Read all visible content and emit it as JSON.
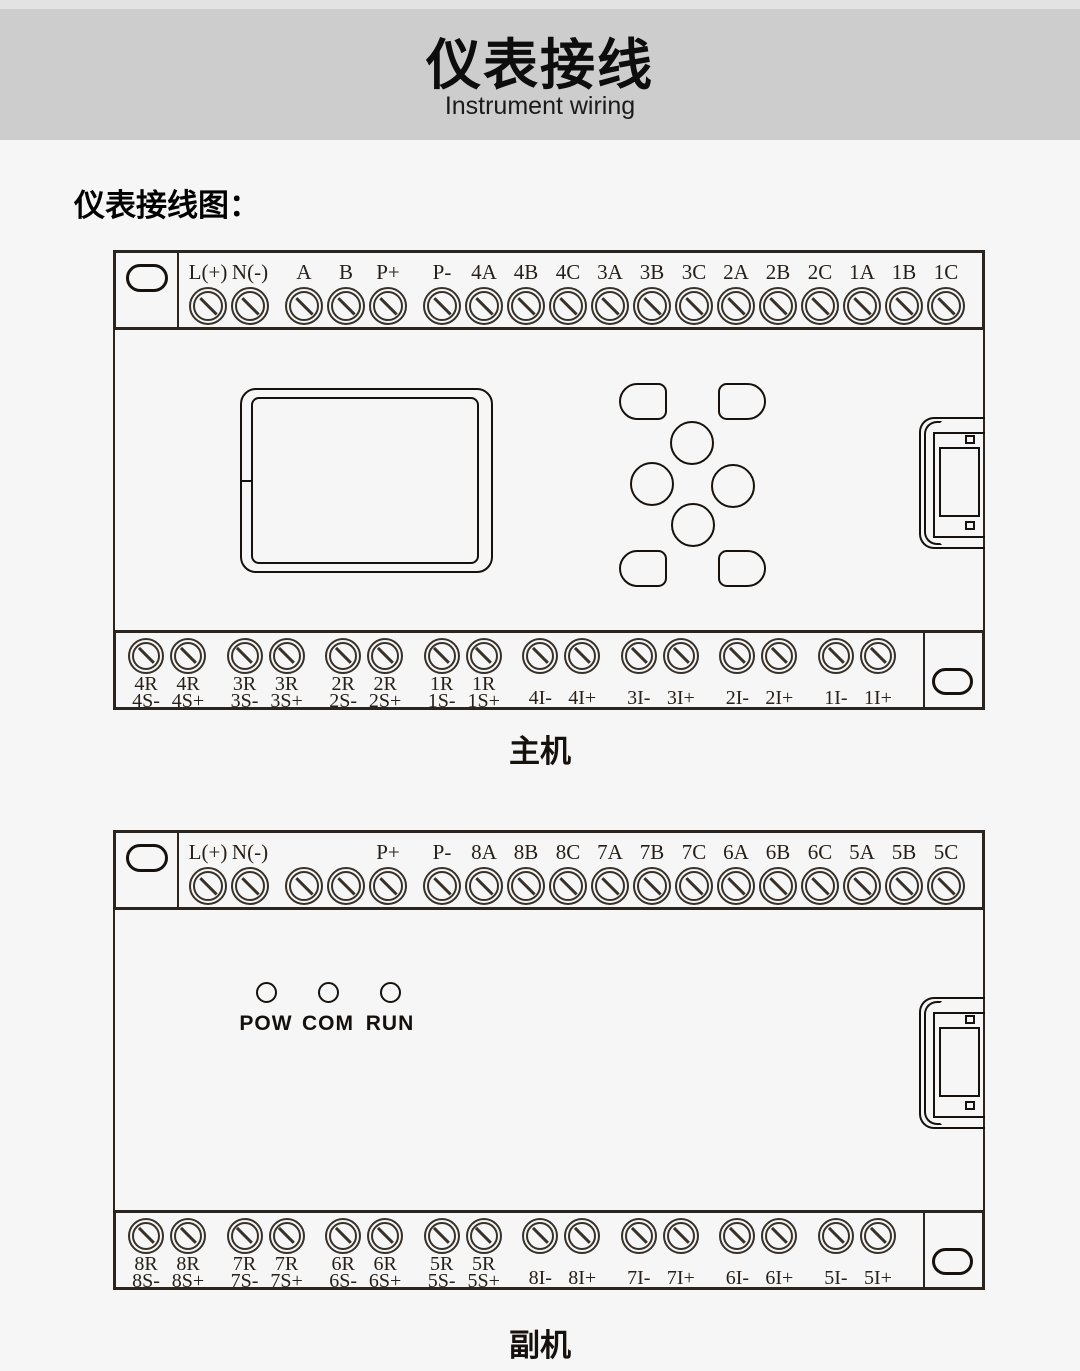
{
  "colors": {
    "page_bg": "#f6f6f6",
    "top_strip": "#e3e3e3",
    "header_band": "#cdcdcd",
    "line": "#2b241f"
  },
  "header": {
    "title": "仪表接线",
    "subtitle": "Instrument wiring"
  },
  "section_heading": "仪表接线图：",
  "main_unit": {
    "caption": "主机",
    "top_groups": [
      [
        "L(+)",
        "N(-)"
      ],
      [
        "A",
        "B",
        "P+"
      ],
      [
        "P-",
        "4A",
        "4B",
        "4C",
        "3A",
        "3B",
        "3C",
        "2A",
        "2B",
        "2C",
        "1A",
        "1B",
        "1C"
      ]
    ],
    "bottom_pairs": [
      [
        {
          "l1": "4R",
          "l2": "4S-"
        },
        {
          "l1": "4R",
          "l2": "4S+"
        }
      ],
      [
        {
          "l1": "3R",
          "l2": "3S-"
        },
        {
          "l1": "3R",
          "l2": "3S+"
        }
      ],
      [
        {
          "l1": "2R",
          "l2": "2S-"
        },
        {
          "l1": "2R",
          "l2": "2S+"
        }
      ],
      [
        {
          "l1": "1R",
          "l2": "1S-"
        },
        {
          "l1": "1R",
          "l2": "1S+"
        }
      ],
      [
        {
          "l1": "",
          "l2": "4I-"
        },
        {
          "l1": "",
          "l2": "4I+"
        }
      ],
      [
        {
          "l1": "",
          "l2": "3I-"
        },
        {
          "l1": "",
          "l2": "3I+"
        }
      ],
      [
        {
          "l1": "",
          "l2": "2I-"
        },
        {
          "l1": "",
          "l2": "2I+"
        }
      ],
      [
        {
          "l1": "",
          "l2": "1I-"
        },
        {
          "l1": "",
          "l2": "1I+"
        }
      ]
    ]
  },
  "sub_unit": {
    "caption": "副机",
    "leds": [
      "POW",
      "COM",
      "RUN"
    ],
    "top_groups": [
      [
        "L(+)",
        "N(-)"
      ],
      [
        "",
        "",
        "P+"
      ],
      [
        "P-",
        "8A",
        "8B",
        "8C",
        "7A",
        "7B",
        "7C",
        "6A",
        "6B",
        "6C",
        "5A",
        "5B",
        "5C"
      ]
    ],
    "bottom_pairs": [
      [
        {
          "l1": "8R",
          "l2": "8S-"
        },
        {
          "l1": "8R",
          "l2": "8S+"
        }
      ],
      [
        {
          "l1": "7R",
          "l2": "7S-"
        },
        {
          "l1": "7R",
          "l2": "7S+"
        }
      ],
      [
        {
          "l1": "6R",
          "l2": "6S-"
        },
        {
          "l1": "6R",
          "l2": "6S+"
        }
      ],
      [
        {
          "l1": "5R",
          "l2": "5S-"
        },
        {
          "l1": "5R",
          "l2": "5S+"
        }
      ],
      [
        {
          "l1": "",
          "l2": "8I-"
        },
        {
          "l1": "",
          "l2": "8I+"
        }
      ],
      [
        {
          "l1": "",
          "l2": "7I-"
        },
        {
          "l1": "",
          "l2": "7I+"
        }
      ],
      [
        {
          "l1": "",
          "l2": "6I-"
        },
        {
          "l1": "",
          "l2": "6I+"
        }
      ],
      [
        {
          "l1": "",
          "l2": "5I-"
        },
        {
          "l1": "",
          "l2": "5I+"
        }
      ]
    ]
  }
}
